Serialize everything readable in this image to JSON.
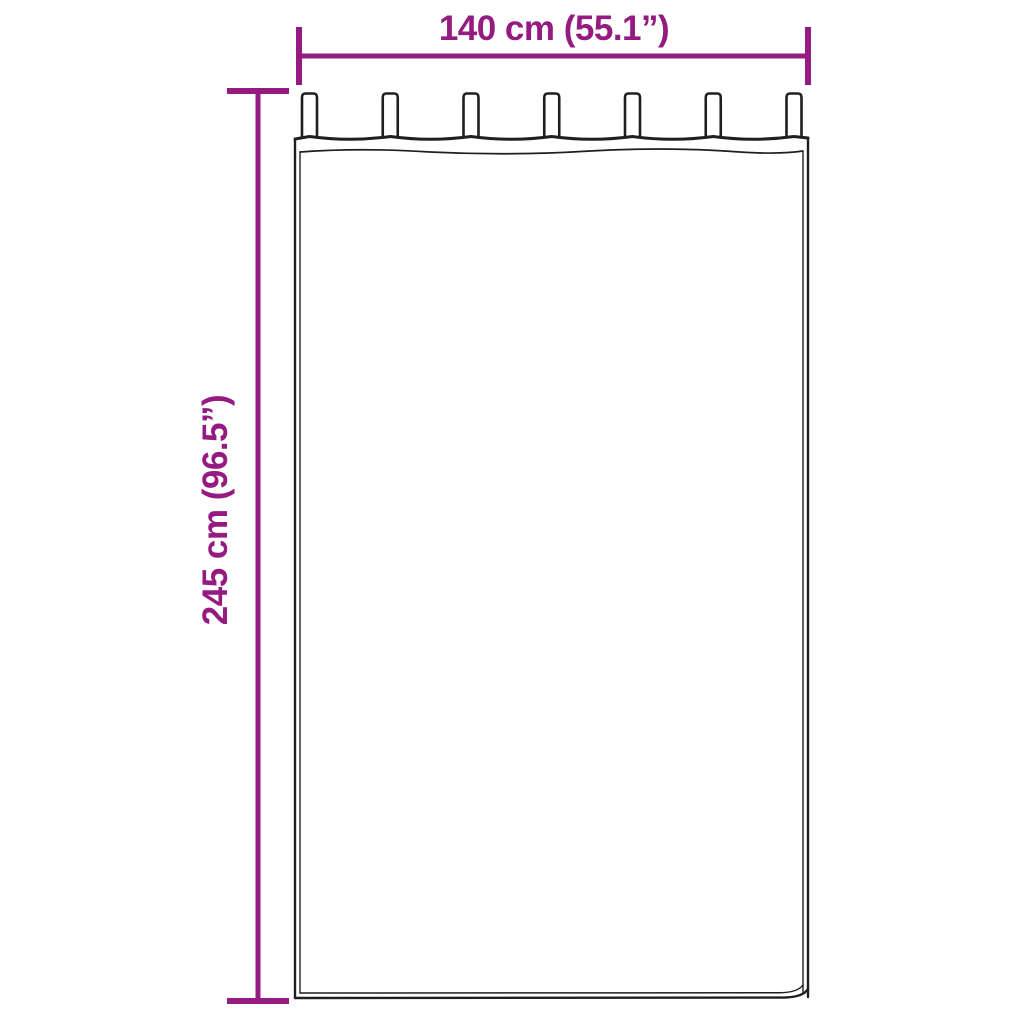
{
  "diagram": {
    "width_label": "140 cm (55.1”)",
    "height_label": "245 cm (96.5”)",
    "tab_count": 7,
    "colors": {
      "dimension_accent": "#951B81",
      "curtain_outline": "#1F1F1F",
      "curtain_fill": "#FFFFFF",
      "background": "#FFFFFF"
    }
  }
}
